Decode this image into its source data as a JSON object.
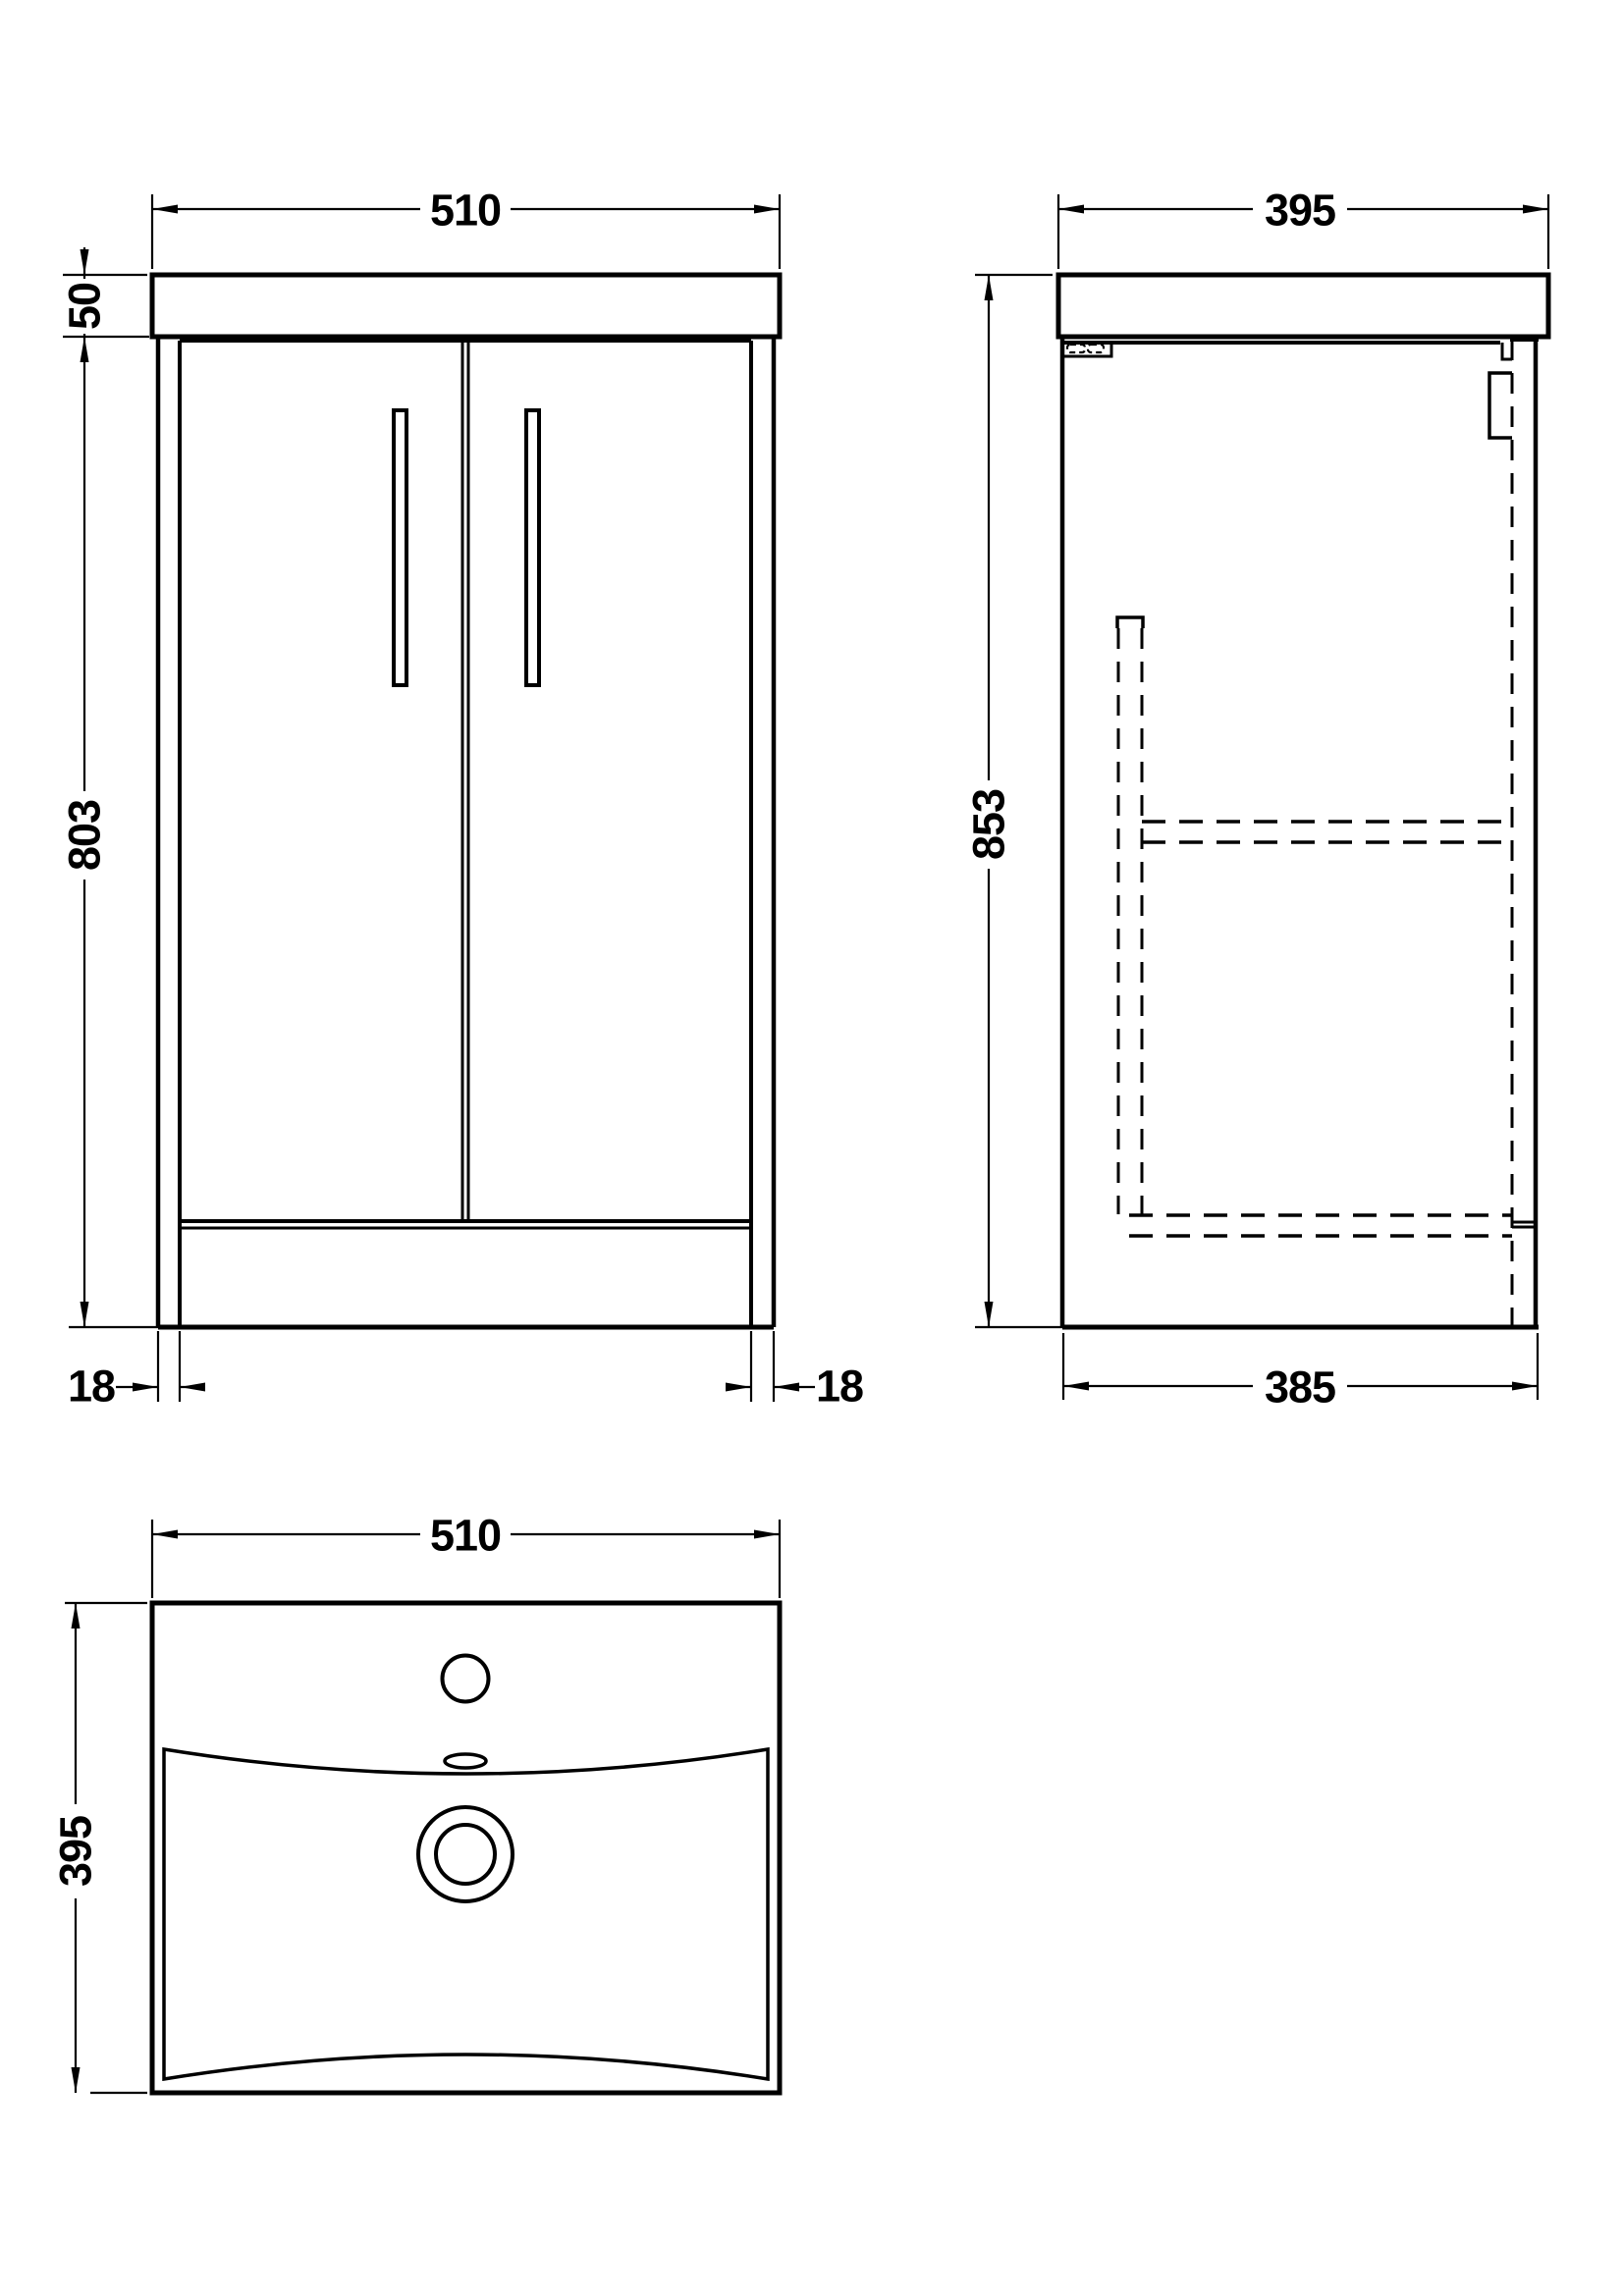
{
  "colors": {
    "line": "#000000",
    "background": "#ffffff"
  },
  "dimensions": {
    "front": {
      "width": "510",
      "worktop_thickness": "50",
      "cabinet_height": "803",
      "left_panel_thickness": "18",
      "right_panel_thickness": "18"
    },
    "side": {
      "overall_depth": "395",
      "overall_height": "853",
      "cabinet_depth": "385"
    },
    "plan": {
      "basin_width": "510",
      "basin_depth": "395"
    }
  }
}
